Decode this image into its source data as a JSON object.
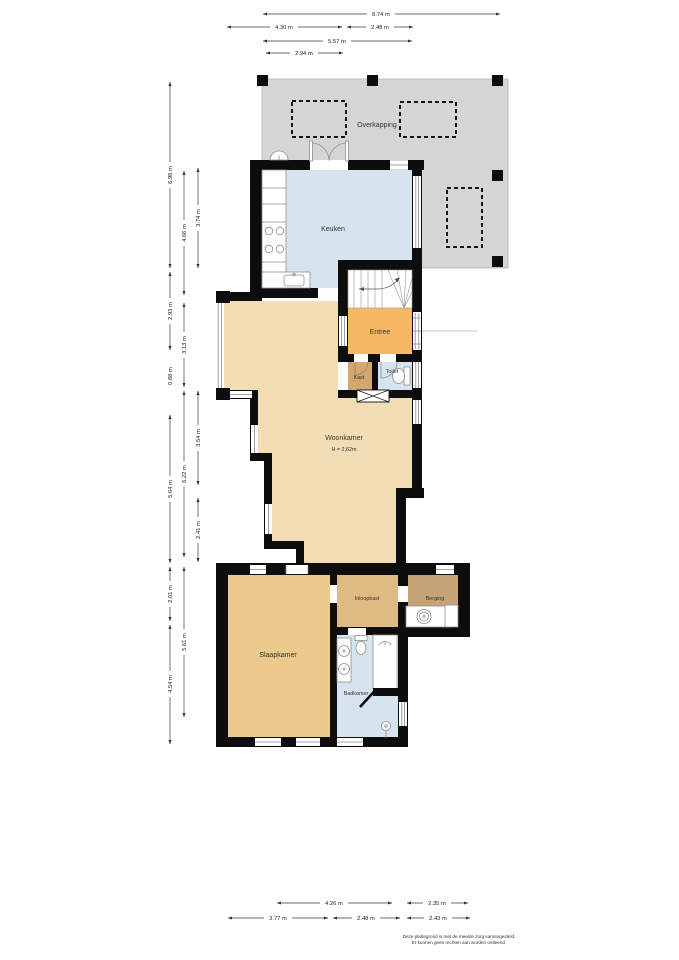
{
  "floorplan": {
    "rooms": {
      "overkapping": "Overkapping",
      "keuken": "Keuken",
      "entree": "Entree",
      "kast": "Kast",
      "toilet": "Toilet",
      "woonkamer": "Woonkamer",
      "woonkamer_ceiling_height": "H = 2,62m",
      "slaapkamer": "Slaapkamer",
      "inloopkast": "Inloopkast",
      "berging": "Berging",
      "badkamer": "Badkamer"
    },
    "dimensions": {
      "top": [
        "8.74 m",
        "4.30 m",
        "2.48 m",
        "5.57 m",
        "2.94 m"
      ],
      "left": [
        "6.98 m",
        "2.93 m",
        "0.88 m",
        "5.64 m",
        "2.01 m",
        "4.54 m",
        "4.66 m",
        "3.13 m",
        "6.22 m",
        "5.61 m",
        "3.74 m",
        "3.54 m",
        "2.41 m"
      ],
      "bottom": [
        "4.26 m",
        "2.35 m",
        "3.77 m",
        "2.48 m",
        "2.43 m"
      ]
    },
    "disclaimer": {
      "line1": "Deze plattegrond is met de meeste zorg samengesteld.",
      "line2": "Er kunnen geen rechten aan worden ontleend."
    },
    "colors": {
      "overkapping": "#d5d5d5",
      "wet_room": "#d7e4f0",
      "woonkamer": "#f2ddb4",
      "entree": "#f6b963",
      "kast": "#d4a76e",
      "slaapkamer": "#ecc98d",
      "inloopkast": "#dfbb82",
      "berging": "#c7a478",
      "wall": "#0d0d0d"
    }
  }
}
